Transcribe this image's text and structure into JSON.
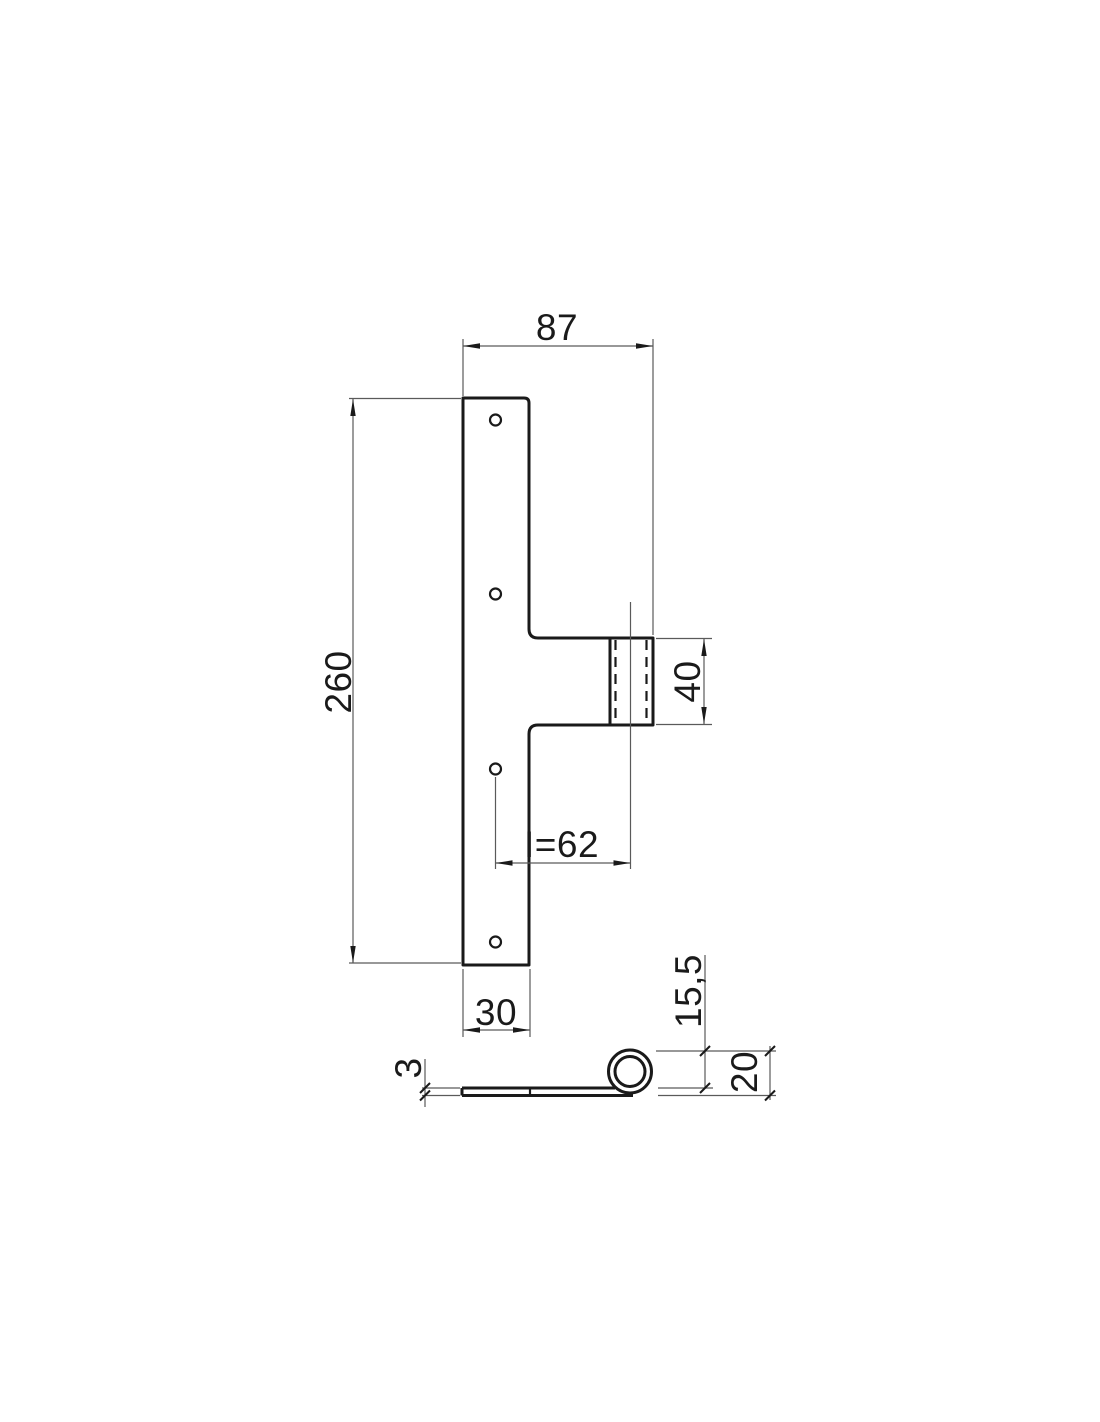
{
  "drawing": {
    "type": "technical-drawing",
    "subject": "T-shaped flag hinge, front view and bottom profile view",
    "background": "#ffffff",
    "colors": {
      "object_line": "#1a1a1a",
      "thin_line": "#5a5a5a",
      "text": "#1a1a1a"
    },
    "front_view": {
      "hole_count": 4,
      "labels": {
        "overall_width": "87",
        "plate_height": "260",
        "arm_height": "40",
        "axis_distance": "I=62",
        "plate_width_bottom": "30"
      }
    },
    "side_view": {
      "labels": {
        "leaf_thickness": "3",
        "knuckle_height_above_leaf": "15,5",
        "knuckle_diameter": "20"
      }
    }
  }
}
